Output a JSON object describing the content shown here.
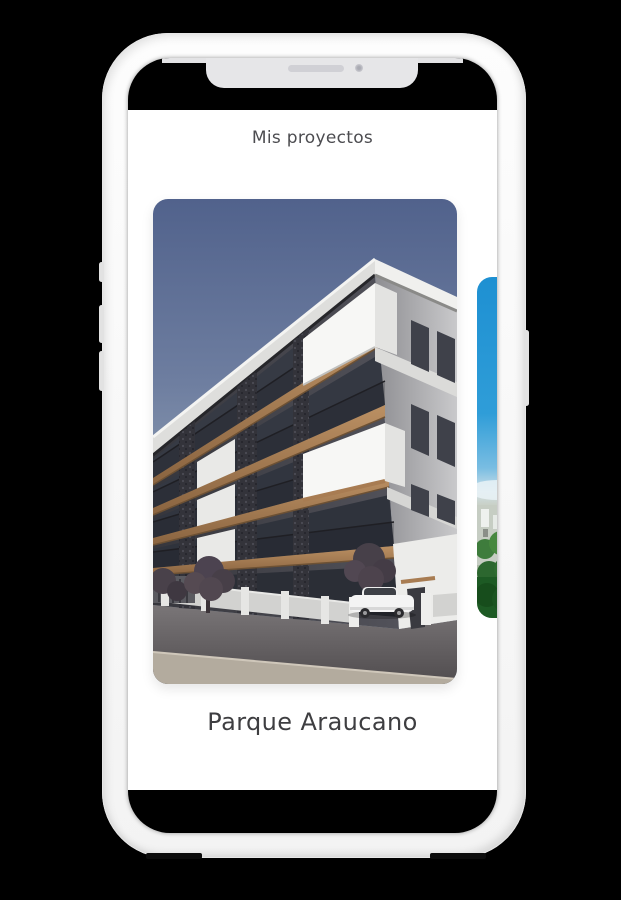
{
  "app": {
    "title": "Mis proyectos",
    "project_name": "Parque Araucano",
    "carousel": {
      "active_card_image": "apartment-building-architectural-render",
      "next_card_image": "sky-city-park-preview"
    }
  },
  "device": {
    "frame": "white-smartphone-mockup",
    "notch": {
      "speaker": "speaker-slot",
      "camera": "front-camera"
    }
  },
  "colors": {
    "background": "#000000",
    "frame": "#f9f9f9",
    "screen_bg": "#ffffff",
    "title_text": "#4c4c50",
    "project_text": "#3e3e41",
    "sky_top": "#51628c",
    "sky_bottom": "#a7b3c2",
    "wood_accent": "#ab815a",
    "preview_sky": "#1e90d2",
    "preview_green": "#2c672f"
  }
}
